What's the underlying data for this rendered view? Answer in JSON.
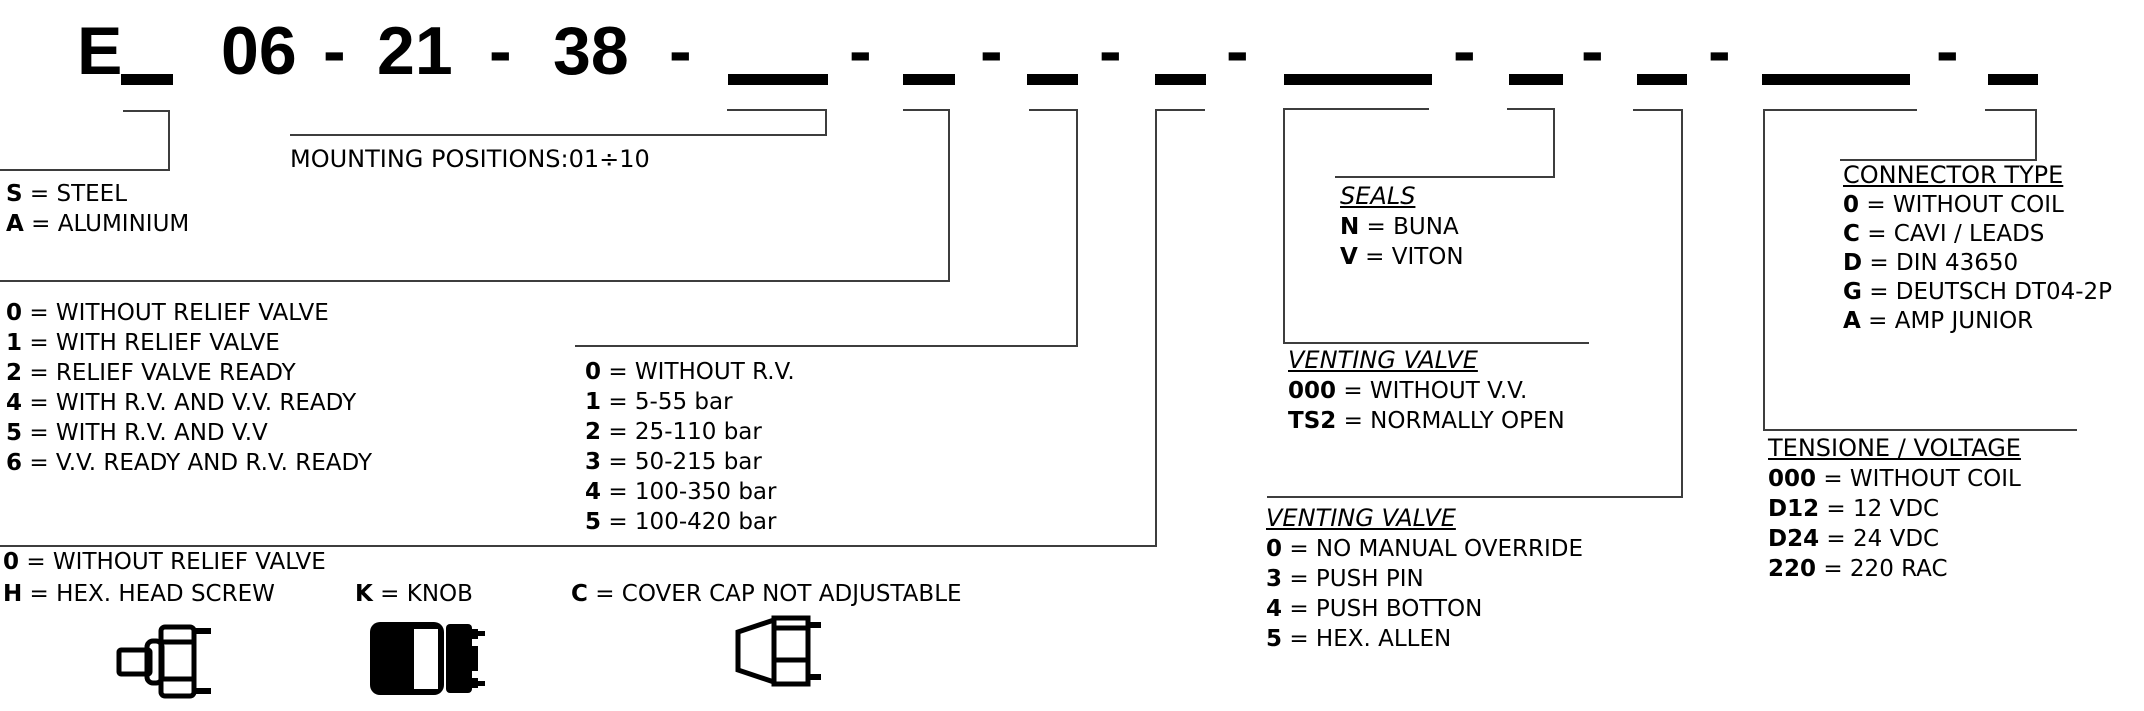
{
  "code": {
    "separator": "-",
    "equals": "=",
    "segments": [
      {
        "kind": "text",
        "value": "E"
      },
      {
        "kind": "blank",
        "field": "material",
        "size": "short"
      },
      {
        "kind": "text",
        "value": "06"
      },
      {
        "kind": "sep"
      },
      {
        "kind": "text",
        "value": "21"
      },
      {
        "kind": "sep"
      },
      {
        "kind": "text",
        "value": "38"
      },
      {
        "kind": "sep"
      },
      {
        "kind": "blank",
        "field": "mounting_position",
        "size": "wide"
      },
      {
        "kind": "sep"
      },
      {
        "kind": "blank",
        "field": "relief_valve_config",
        "size": "short"
      },
      {
        "kind": "sep"
      },
      {
        "kind": "blank",
        "field": "pressure_range",
        "size": "short"
      },
      {
        "kind": "sep"
      },
      {
        "kind": "blank",
        "field": "adjustment",
        "size": "short"
      },
      {
        "kind": "sep"
      },
      {
        "kind": "blank",
        "field": "venting_valve_type",
        "size": "wide"
      },
      {
        "kind": "sep"
      },
      {
        "kind": "blank",
        "field": "seals",
        "size": "short"
      },
      {
        "kind": "sep"
      },
      {
        "kind": "blank",
        "field": "venting_override",
        "size": "short"
      },
      {
        "kind": "sep"
      },
      {
        "kind": "blank",
        "field": "voltage",
        "size": "wide"
      },
      {
        "kind": "sep"
      },
      {
        "kind": "blank",
        "field": "connector_type",
        "size": "short"
      }
    ]
  },
  "legends": {
    "material": {
      "items": [
        {
          "code": "S",
          "label": "STEEL"
        },
        {
          "code": "A",
          "label": "ALUMINIUM"
        }
      ]
    },
    "mounting": {
      "text": "MOUNTING POSITIONS:01÷10"
    },
    "relief_config": {
      "items": [
        {
          "code": "0",
          "label": "WITHOUT RELIEF VALVE"
        },
        {
          "code": "1",
          "label": "WITH RELIEF VALVE"
        },
        {
          "code": "2",
          "label": "RELIEF VALVE READY"
        },
        {
          "code": "4",
          "label": "WITH R.V. AND V.V. READY"
        },
        {
          "code": "5",
          "label": "WITH R.V. AND V.V"
        },
        {
          "code": "6",
          "label": "V.V. READY AND R.V. READY"
        }
      ]
    },
    "pressure": {
      "items": [
        {
          "code": "0",
          "label": "WITHOUT R.V."
        },
        {
          "code": "1",
          "label": "5-55 bar"
        },
        {
          "code": "2",
          "label": "25-110 bar"
        },
        {
          "code": "3",
          "label": "50-215 bar"
        },
        {
          "code": "4",
          "label": "100-350 bar"
        },
        {
          "code": "5",
          "label": "100-420 bar"
        }
      ]
    },
    "adjustment": {
      "row1": [
        {
          "code": "0",
          "label": "WITHOUT RELIEF VALVE"
        }
      ],
      "row2": [
        {
          "code": "H",
          "label": "HEX. HEAD SCREW"
        },
        {
          "code": "K",
          "label": "KNOB"
        },
        {
          "code": "C",
          "label": "COVER CAP NOT ADJUSTABLE"
        }
      ]
    },
    "venting_type": {
      "title": "VENTING VALVE",
      "items": [
        {
          "code": "000",
          "label": "WITHOUT V.V."
        },
        {
          "code": "TS2",
          "label": "NORMALLY OPEN"
        }
      ]
    },
    "seals": {
      "title": "SEALS",
      "items": [
        {
          "code": "N",
          "label": "BUNA"
        },
        {
          "code": "V",
          "label": "VITON"
        }
      ]
    },
    "venting_override": {
      "title": "VENTING VALVE",
      "items": [
        {
          "code": "0",
          "label": "NO MANUAL OVERRIDE"
        },
        {
          "code": "3",
          "label": "PUSH PIN"
        },
        {
          "code": "4",
          "label": "PUSH BOTTON"
        },
        {
          "code": "5",
          "label": "HEX. ALLEN"
        }
      ]
    },
    "voltage": {
      "title": "TENSIONE / VOLTAGE",
      "items": [
        {
          "code": "000",
          "label": "WITHOUT COIL"
        },
        {
          "code": "D12",
          "label": "12 VDC"
        },
        {
          "code": "D24",
          "label": "24 VDC"
        },
        {
          "code": "220",
          "label": "220 RAC"
        }
      ]
    },
    "connector": {
      "title": "CONNECTOR TYPE",
      "items": [
        {
          "code": "0",
          "label": "WITHOUT COIL"
        },
        {
          "code": "C",
          "label": "CAVI / LEADS"
        },
        {
          "code": "D",
          "label": "DIN 43650"
        },
        {
          "code": "G",
          "label": "DEUTSCH DT04-2P"
        },
        {
          "code": "A",
          "label": "AMP JUNIOR"
        }
      ]
    }
  }
}
